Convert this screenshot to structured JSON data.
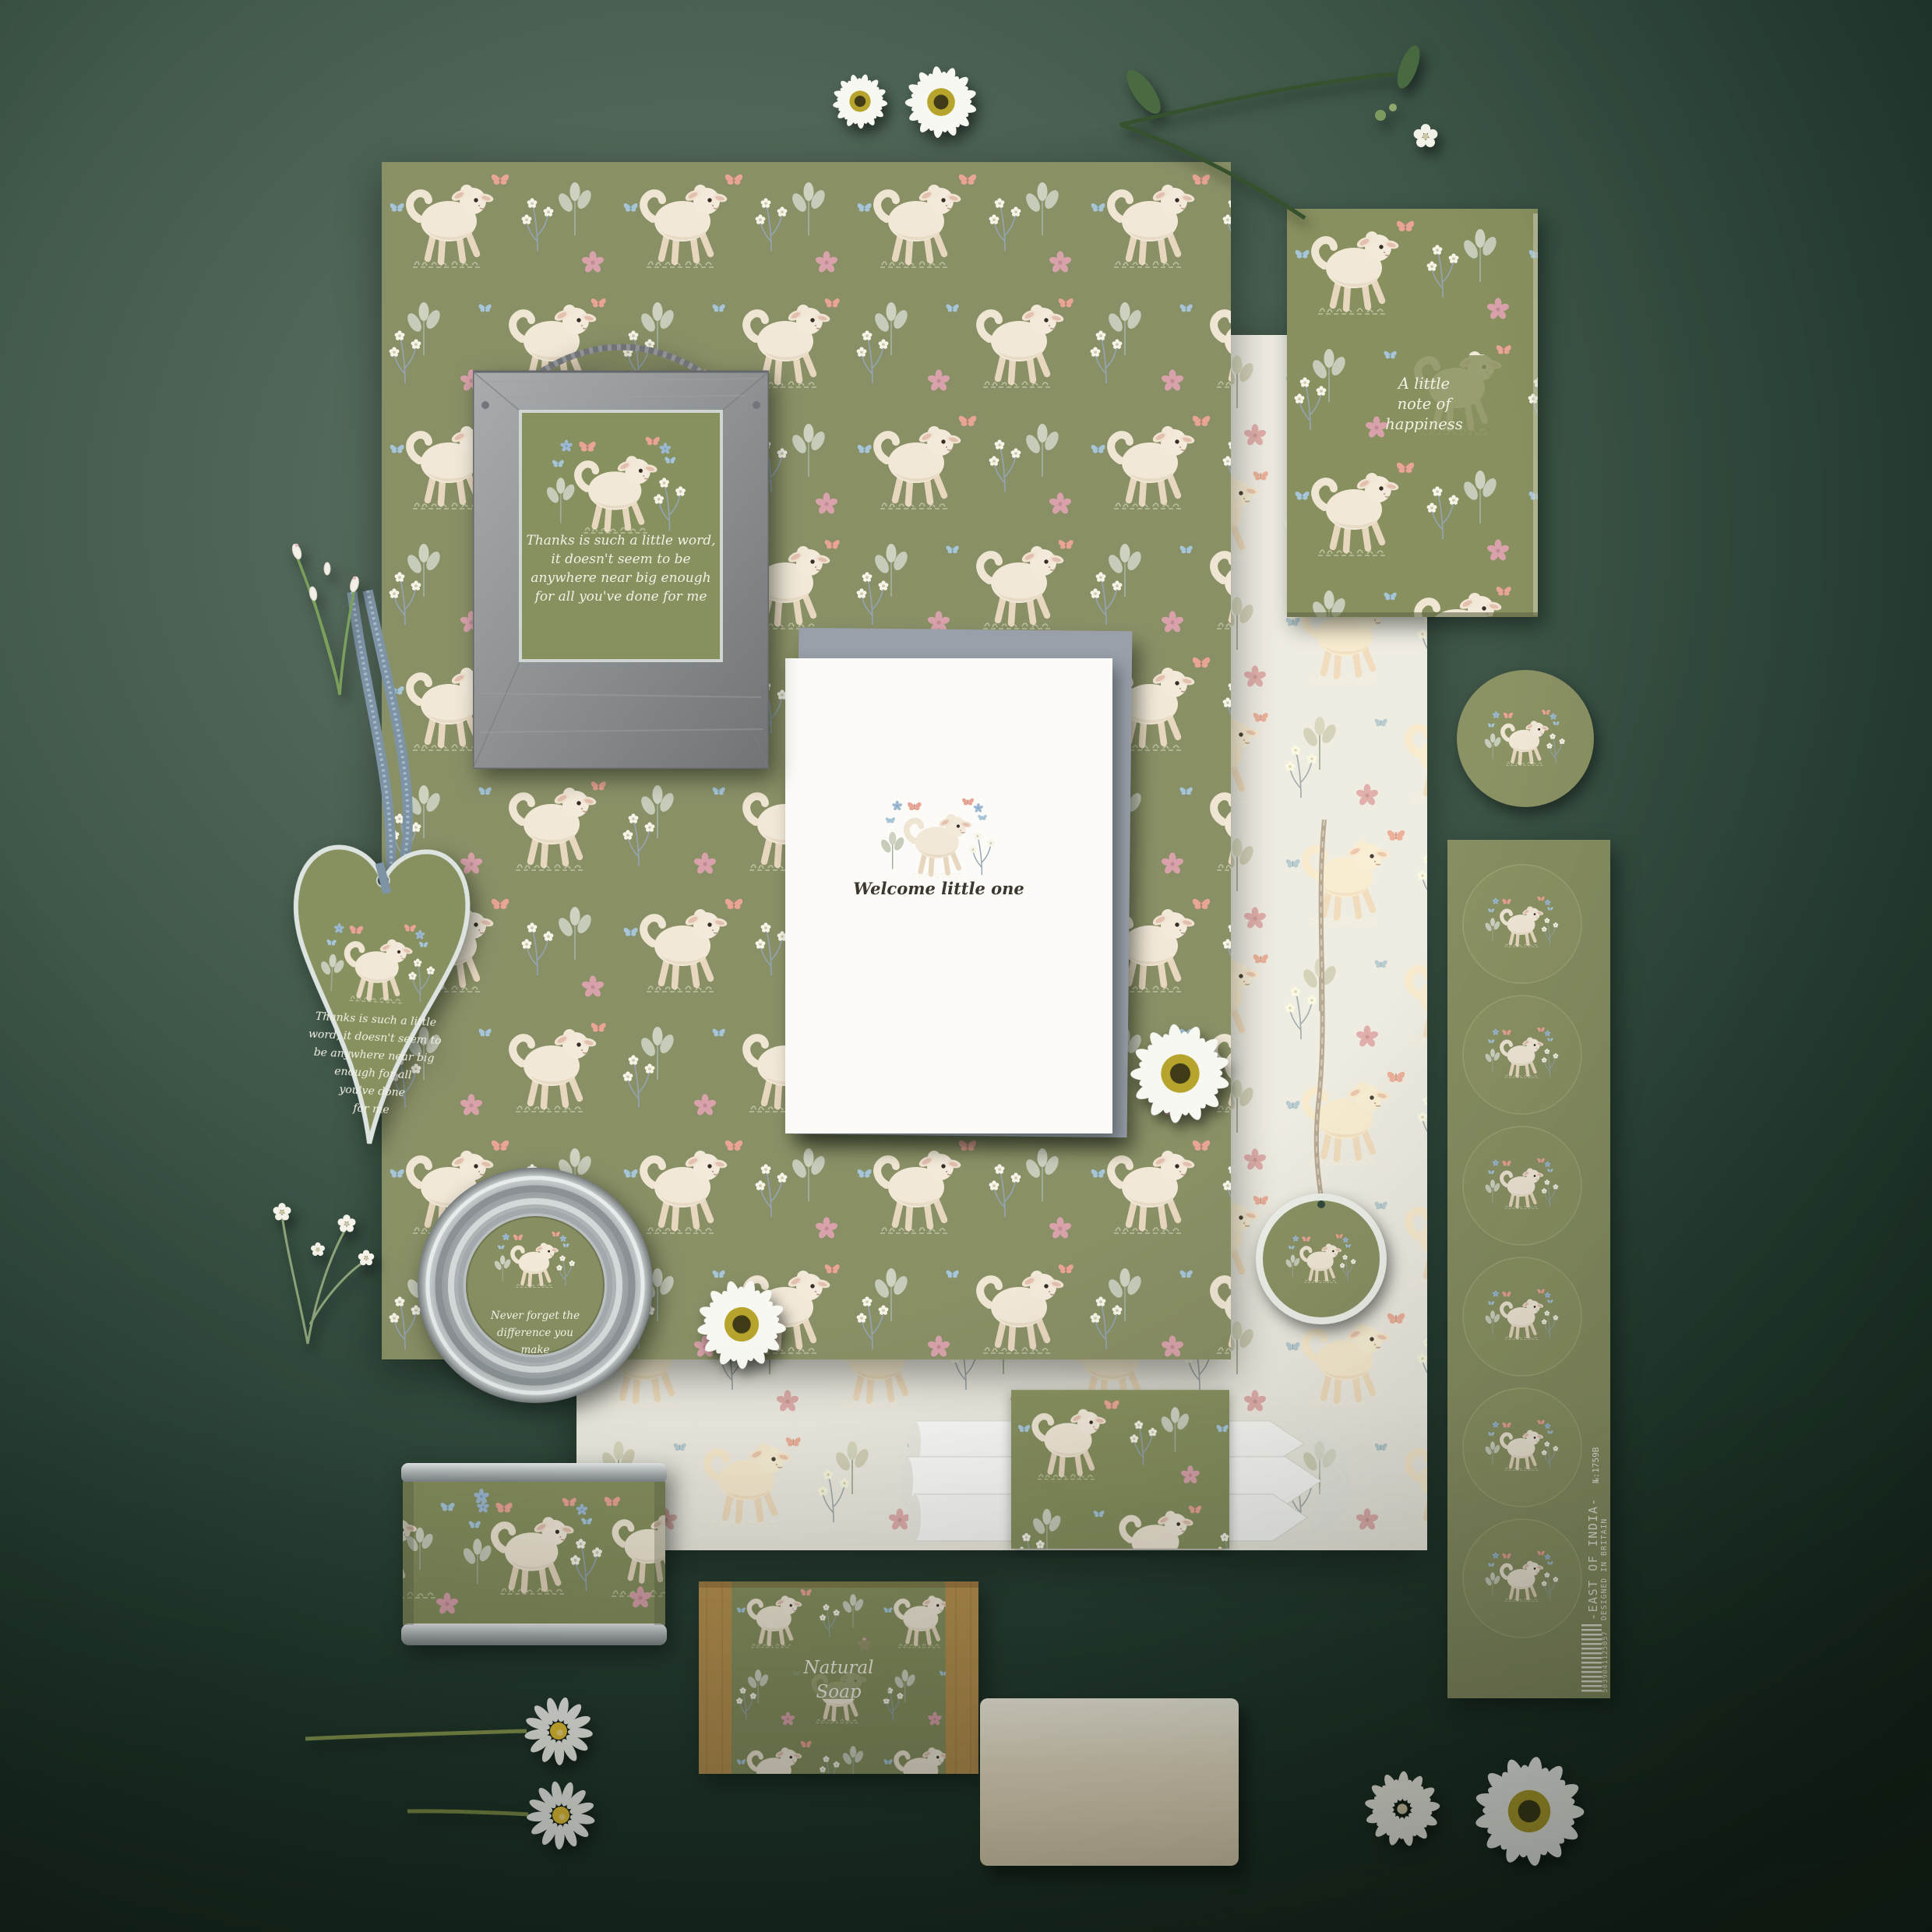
{
  "photo": {
    "description": "Flat lay photo of an olive-green watercolour lamb stationery and gift collection on a dark green background"
  },
  "frame": {
    "line1": "Thanks is such a little word,",
    "line2": "it doesn't seem to be",
    "line3": "anywhere near big enough",
    "line4": "for all you've done for me"
  },
  "heart": {
    "line1": "Thanks is such a little",
    "line2": "word, it doesn't seem to",
    "line3": "be anywhere near big",
    "line4": "enough for all",
    "line5": "you've done",
    "line6": "for me"
  },
  "card": {
    "caption": "Welcome little one"
  },
  "notebook": {
    "line1": "A little",
    "line2": "note of",
    "line3": "happiness"
  },
  "lid": {
    "line1": "Never forget the",
    "line2": "difference you",
    "line3": "make"
  },
  "soap": {
    "line1": "Natural",
    "line2": "Soap"
  },
  "brand": {
    "name": "-EAST OF INDIA-",
    "origin": "DESIGNED IN BRITAIN",
    "sku": "№:1759B",
    "barcode_digits": "5039041125057"
  },
  "palette": {
    "background": "#2e463a",
    "paper_olive": "#8a9066",
    "tissue": "#efece2",
    "frame_grey": "#8e9092",
    "envelope_grey": "#9aa0aa",
    "card_white": "#fcfbf7",
    "kraft": "#bf9a5f",
    "silver": "#c6cacc",
    "script_text": "#f2f1e4",
    "caption_text": "#3d382f",
    "lamb": "#f1e8d7",
    "flower_pink": "#d9a2ab",
    "butterfly_pink": "#e8a495",
    "butterfly_blue": "#a6c6d8",
    "ribbon_blue": "#7d93a6",
    "twine": "#b7a993"
  }
}
